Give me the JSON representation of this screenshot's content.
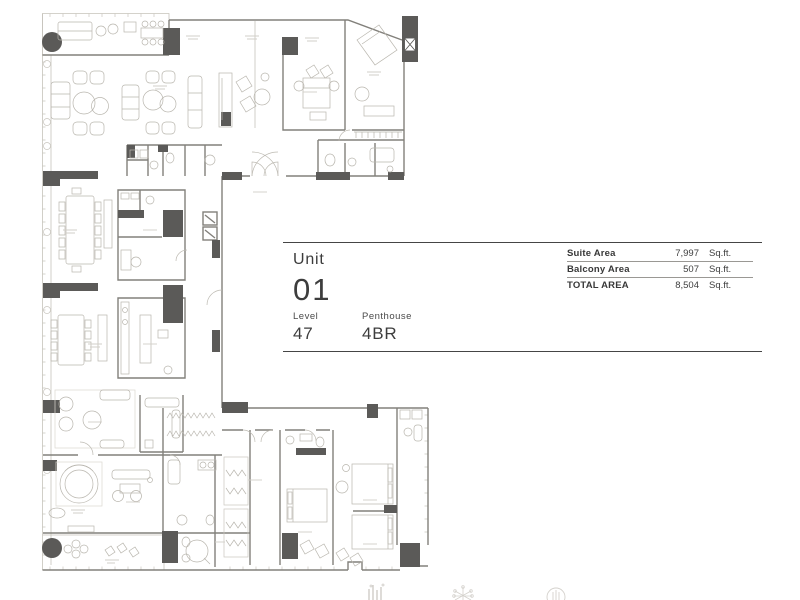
{
  "page": {
    "background": "#ffffff"
  },
  "info_panel": {
    "unit": {
      "label": "Unit",
      "number": "01"
    },
    "level": {
      "label": "Level",
      "value": "47"
    },
    "unit_type": {
      "label": "Penthouse",
      "value": "4BR"
    },
    "area_table": {
      "rows": [
        {
          "label": "Suite Area",
          "value": "7,997",
          "unit": "Sq.ft."
        },
        {
          "label": "Balcony Area",
          "value": "507",
          "unit": "Sq.ft."
        },
        {
          "label": "TOTAL AREA",
          "value": "8,504",
          "unit": "Sq.ft."
        }
      ]
    }
  },
  "floor_plan": {
    "type": "architectural-floor-plan",
    "elevator_marker": "X",
    "colors": {
      "wall_dark": "#5b5a58",
      "wall_mid": "#82807b",
      "furniture_line": "#b9b6ae",
      "faint_line": "#cdcac3"
    }
  },
  "footer": {
    "icons": [
      "skyline-icon",
      "snowflake-icon",
      "circle-emblem-icon"
    ]
  }
}
